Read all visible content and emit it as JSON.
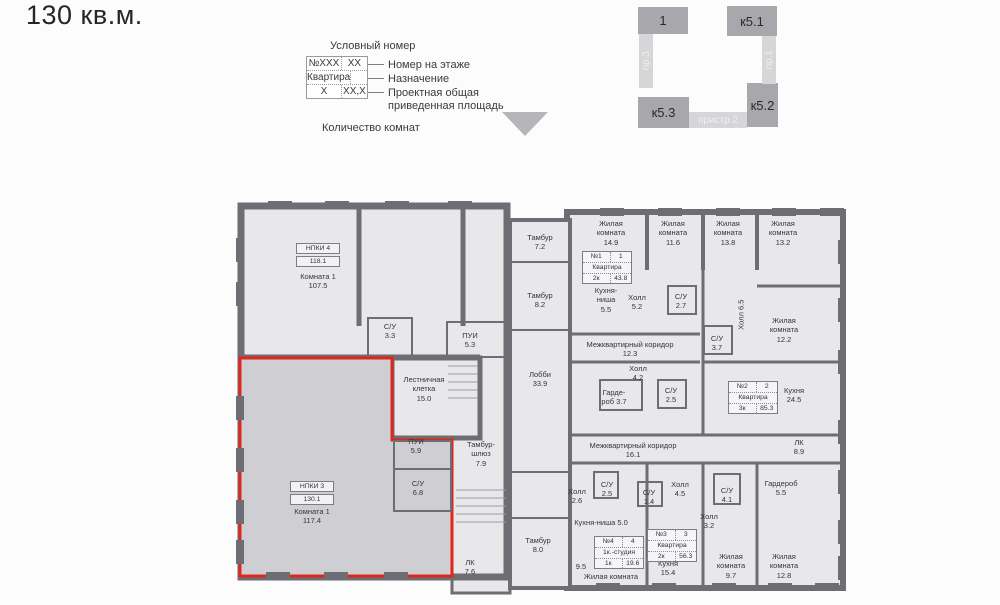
{
  "title": "130 кв.м.",
  "legend": {
    "title": "Условный номер",
    "box": {
      "num": "№XXX",
      "floor_num": "XX",
      "designation": "Квартира",
      "rooms": "X",
      "area": "XX,X"
    },
    "floor_label": "Номер на этаже",
    "designation_label": "Назначение",
    "area_label": "Проектная общая\nприведенная площадь",
    "rooms_label": "Количество комнат"
  },
  "keyplan": {
    "block_1": "1",
    "block_k51": "к5.1",
    "block_k52": "к5.2",
    "block_k53": "к5.3",
    "strip_pr3": "пр.3",
    "strip_pr1": "пр.1",
    "strip_pristr2": "пристр.2"
  },
  "plan": {
    "rooms": [
      "С/У\n3.3",
      "ПУИ\n5.3",
      "Комната 1\n107.5",
      "Лестничная\nклетка\n15.0",
      "ПУИ\n5.9",
      "С/У\n6.8",
      "Комната 1\n117.4",
      "Тамбур\n7.2",
      "Тамбур\n8.2",
      "Лобби\n33.9",
      "Тамбур-\nшлюз\n7.9",
      "Тамбур\n8.0",
      "ЛК\n7.6",
      "Жилая\nкомната\n14.9",
      "Кухня-\nниша\n5.5",
      "Холл\n5.2",
      "Межквартирный коридор\n12.3",
      "Холл\n4.2",
      "Гарде-\nроб 3.7",
      "С/У\n2.5",
      "Жилая\nкомната\n11.6",
      "Жилая\nкомната\n13.8",
      "Жилая\nкомната\n13.2",
      "С/У\n2.7",
      "Холл 6.5",
      "С/У\n3.7",
      "Жилая\nкомната\n12.2",
      "Кухня\n24.5",
      "ЛК\n8.9",
      "Межквартирный коридор\n16.1",
      "Холл\n2.6",
      "С/У\n2.5",
      "С/У\n1.4",
      "Холл\n4.5",
      "С/У\n4.1",
      "Гардероб\n5.5",
      "Холл\n3.2",
      "Кухня-ниша 5.0",
      "9.5",
      "Жилая комната",
      "Кухня\n15.4",
      "Жилая\nкомната\n9.7",
      "Жилая\nкомната\n12.8"
    ],
    "tags": [
      {
        "num": "№1",
        "count": "1",
        "designation": "Квартира",
        "rooms": "2к",
        "area": "43.8"
      },
      {
        "num": "№2",
        "count": "2",
        "designation": "Квартира",
        "rooms": "3к",
        "area": "85.3"
      },
      {
        "num": "№3",
        "count": "3",
        "designation": "Квартира",
        "rooms": "2к",
        "area": "56.3"
      },
      {
        "num": "№4",
        "count": "4",
        "designation": "1к.-студия",
        "rooms": "1к",
        "area": "19.6"
      }
    ],
    "np_tags": [
      {
        "name": "НПКИ 4",
        "area": "118.1"
      },
      {
        "name": "НПКИ 3",
        "area": "130.1"
      }
    ]
  },
  "colors": {
    "highlight_outline": "#e0251b",
    "walls": "#6d6d73",
    "room_fill": "#e8e8eb",
    "highlight_fill": "#cfcfd3",
    "keyplan_block": "#a8a8ac",
    "keyplan_strip": "#d6d6d9",
    "text": "#3a3a3e"
  }
}
